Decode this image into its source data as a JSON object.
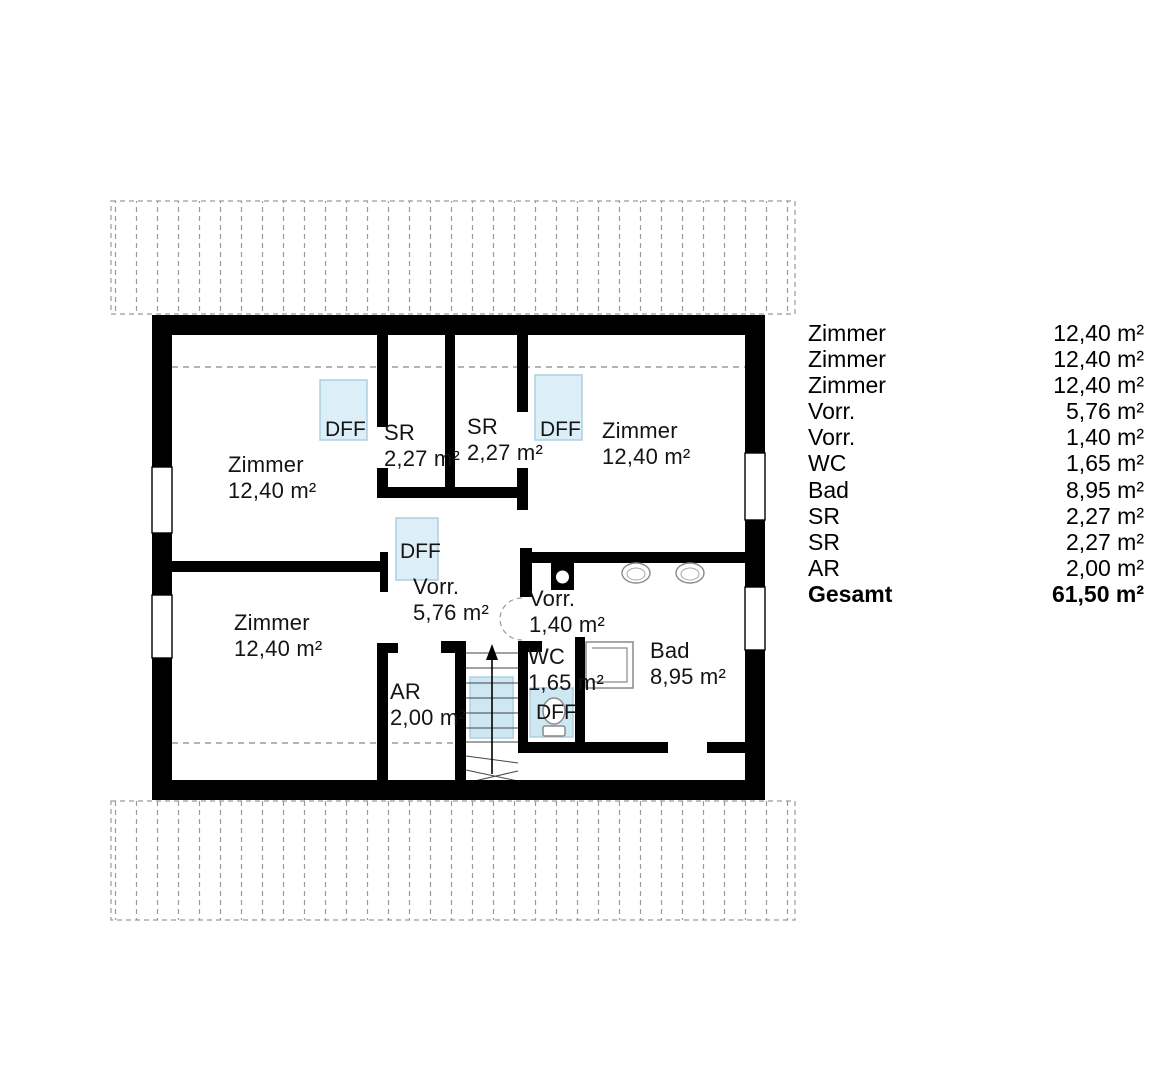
{
  "plan": {
    "title": "attic floor plan",
    "skylight_label": "DFF",
    "rooms": [
      {
        "name": "Zimmer",
        "area": "12,40 m²"
      },
      {
        "name": "Zimmer",
        "area": "12,40 m²"
      },
      {
        "name": "Zimmer",
        "area": "12,40 m²"
      },
      {
        "name": "SR",
        "area": "2,27 m²"
      },
      {
        "name": "SR",
        "area": "2,27 m²"
      },
      {
        "name": "Vorr.",
        "area": "5,76 m²"
      },
      {
        "name": "Vorr.",
        "area": "1,40 m²"
      },
      {
        "name": "WC",
        "area": "1,65 m²"
      },
      {
        "name": "Bad",
        "area": "8,95 m²"
      },
      {
        "name": "AR",
        "area": "2,00 m²"
      }
    ]
  },
  "legend": {
    "rows": [
      {
        "label": "Zimmer",
        "value": "12,40 m²"
      },
      {
        "label": "Zimmer",
        "value": "12,40 m²"
      },
      {
        "label": "Zimmer",
        "value": "12,40 m²"
      },
      {
        "label": "Vorr.",
        "value": "5,76 m²"
      },
      {
        "label": "Vorr.",
        "value": "1,40 m²"
      },
      {
        "label": "WC",
        "value": "1,65 m²"
      },
      {
        "label": "Bad",
        "value": "8,95 m²"
      },
      {
        "label": "SR",
        "value": "2,27 m²"
      },
      {
        "label": "SR",
        "value": "2,27 m²"
      },
      {
        "label": "AR",
        "value": "2,00 m²"
      },
      {
        "label": "Gesamt",
        "value": "61,50 m²"
      }
    ]
  },
  "colors": {
    "wall": "#000000",
    "skylight_fill": "#dceef8",
    "skylight_border": "#aecfe0",
    "hatch_line": "#9a9a9a",
    "fixture_line": "#8a8a8a"
  }
}
